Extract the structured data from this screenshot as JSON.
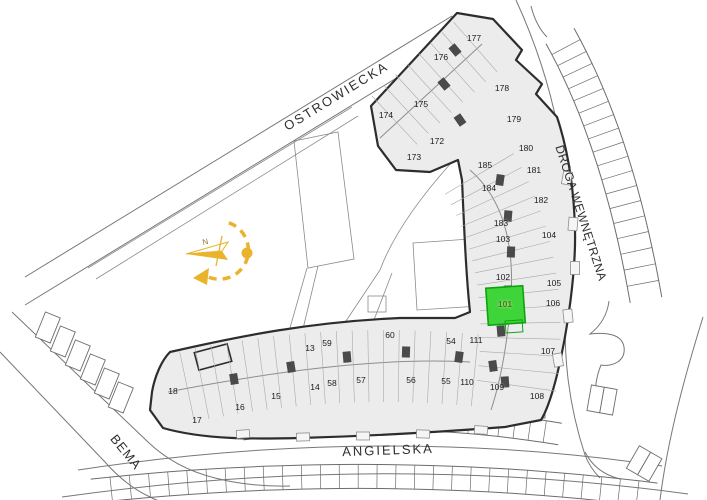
{
  "plan": {
    "title": "osiedle site plan",
    "highlighted_unit": "101",
    "highlight_color": "#3fd43a",
    "highlight_border_color": "#0da30d",
    "highlight_text_color": "#4c7a0b",
    "compass": {
      "north_label": "N",
      "color": "#e9b32c"
    }
  },
  "streets": [
    {
      "id": "ostrowiecka",
      "name": "OSTROWIECKA",
      "x": 336,
      "y": 96,
      "rotation": -31.5,
      "size": 13,
      "spacing": 2
    },
    {
      "id": "droga-wewnetrzna",
      "name": "DROGA WEWNĘTRZNA",
      "x": 581,
      "y": 213,
      "rotation": 72,
      "size": 12,
      "spacing": 0.5
    },
    {
      "id": "angielska",
      "name": "ANGIELSKA",
      "x": 388,
      "y": 450,
      "rotation": -2,
      "size": 13,
      "spacing": 2
    },
    {
      "id": "bema",
      "name": "BEMA",
      "x": 126,
      "y": 452,
      "rotation": 51,
      "size": 13,
      "spacing": 1
    }
  ],
  "buildings": [
    {
      "id": "north-building",
      "units": [
        {
          "n": "174",
          "x": 386,
          "y": 115
        },
        {
          "n": "175",
          "x": 421,
          "y": 104
        },
        {
          "n": "176",
          "x": 441,
          "y": 57
        },
        {
          "n": "177",
          "x": 474,
          "y": 38
        },
        {
          "n": "172",
          "x": 437,
          "y": 141
        },
        {
          "n": "173",
          "x": 414,
          "y": 157
        },
        {
          "n": "178",
          "x": 502,
          "y": 88
        },
        {
          "n": "179",
          "x": 514,
          "y": 119
        },
        {
          "n": "180",
          "x": 526,
          "y": 148
        }
      ]
    },
    {
      "id": "east-building",
      "units": [
        {
          "n": "185",
          "x": 485,
          "y": 165
        },
        {
          "n": "181",
          "x": 534,
          "y": 170
        },
        {
          "n": "184",
          "x": 489,
          "y": 188
        },
        {
          "n": "182",
          "x": 541,
          "y": 200
        },
        {
          "n": "183",
          "x": 501,
          "y": 223
        },
        {
          "n": "103",
          "x": 503,
          "y": 239
        },
        {
          "n": "104",
          "x": 549,
          "y": 235
        },
        {
          "n": "102",
          "x": 503,
          "y": 277
        },
        {
          "n": "105",
          "x": 554,
          "y": 283
        },
        {
          "n": "101",
          "x": 505,
          "y": 304
        },
        {
          "n": "106",
          "x": 553,
          "y": 303
        },
        {
          "n": "107",
          "x": 548,
          "y": 351
        },
        {
          "n": "109",
          "x": 497,
          "y": 387
        },
        {
          "n": "108",
          "x": 537,
          "y": 396
        }
      ]
    },
    {
      "id": "south-building",
      "units": [
        {
          "n": "18",
          "x": 173,
          "y": 391
        },
        {
          "n": "17",
          "x": 197,
          "y": 420
        },
        {
          "n": "16",
          "x": 240,
          "y": 407
        },
        {
          "n": "15",
          "x": 276,
          "y": 396
        },
        {
          "n": "14",
          "x": 315,
          "y": 387
        },
        {
          "n": "13",
          "x": 310,
          "y": 348
        },
        {
          "n": "59",
          "x": 327,
          "y": 343
        },
        {
          "n": "58",
          "x": 332,
          "y": 383
        },
        {
          "n": "57",
          "x": 361,
          "y": 380
        },
        {
          "n": "60",
          "x": 390,
          "y": 335
        },
        {
          "n": "56",
          "x": 411,
          "y": 380
        },
        {
          "n": "55",
          "x": 446,
          "y": 381
        },
        {
          "n": "54",
          "x": 451,
          "y": 341
        },
        {
          "n": "110",
          "x": 467,
          "y": 382
        },
        {
          "n": "111",
          "x": 476,
          "y": 340
        }
      ]
    }
  ]
}
